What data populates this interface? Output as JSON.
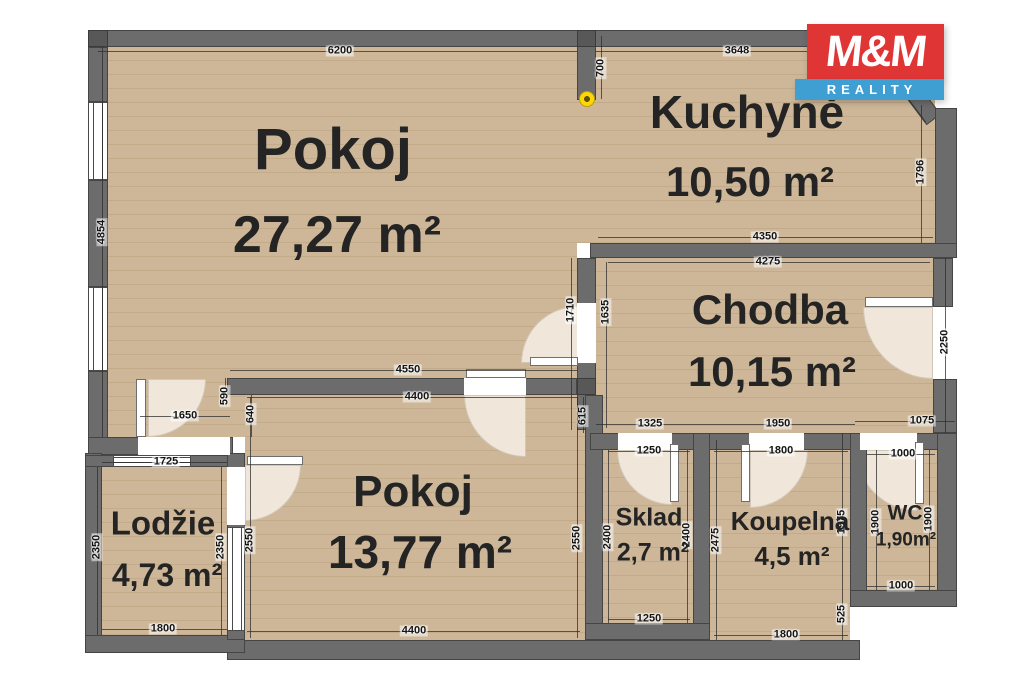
{
  "logo": {
    "line1": "M&M",
    "line2": "REALITY"
  },
  "rooms": [
    {
      "name": "Pokoj",
      "area": "27,27 m²"
    },
    {
      "name": "Kuchyně",
      "area": "10,50 m²"
    },
    {
      "name": "Chodba",
      "area": "10,15 m²"
    },
    {
      "name": "Pokoj",
      "area": "13,77 m²"
    },
    {
      "name": "Lodžie",
      "area": "4,73 m²"
    },
    {
      "name": "Sklad",
      "area": "2,7 m²"
    },
    {
      "name": "Koupelna",
      "area": "4,5 m²"
    },
    {
      "name": "WC",
      "area": "1,90m²"
    }
  ],
  "dims": {
    "d6200": "6200",
    "d700": "700",
    "d3648": "3648",
    "d4854": "4854",
    "d1796": "1796",
    "d4350": "4350",
    "d4275": "4275",
    "d1710": "1710",
    "d1635": "1635",
    "d2250": "2250",
    "d4550": "4550",
    "d4400_mid": "4400",
    "d590": "590",
    "d640": "640",
    "d1650": "1650",
    "d1725": "1725",
    "d2350_l": "2350",
    "d2350_r": "2350",
    "d2550_l": "2550",
    "d2550_r": "2550",
    "d615": "615",
    "d2400_l": "2400",
    "d2400_r": "2400",
    "d2475": "2475",
    "d1975": "1975",
    "d525": "525",
    "d1900_l": "1900",
    "d1900_r": "1900",
    "d1325": "1325",
    "d1950": "1950",
    "d1075": "1075",
    "d1000_top": "1000",
    "d1000_bottom": "1000",
    "d1250_top": "1250",
    "d1250_bottom": "1250",
    "d1800_koup_top": "1800",
    "d1800_koup_bottom": "1800",
    "d1800_lodzie": "1800",
    "d4400_bottom": "4400"
  },
  "colors": {
    "wall": "#6c6c6c",
    "floor": "#c9b394",
    "logo_red": "#e03535",
    "logo_blue": "#3f9fd3",
    "marker": "#ffd60a"
  }
}
